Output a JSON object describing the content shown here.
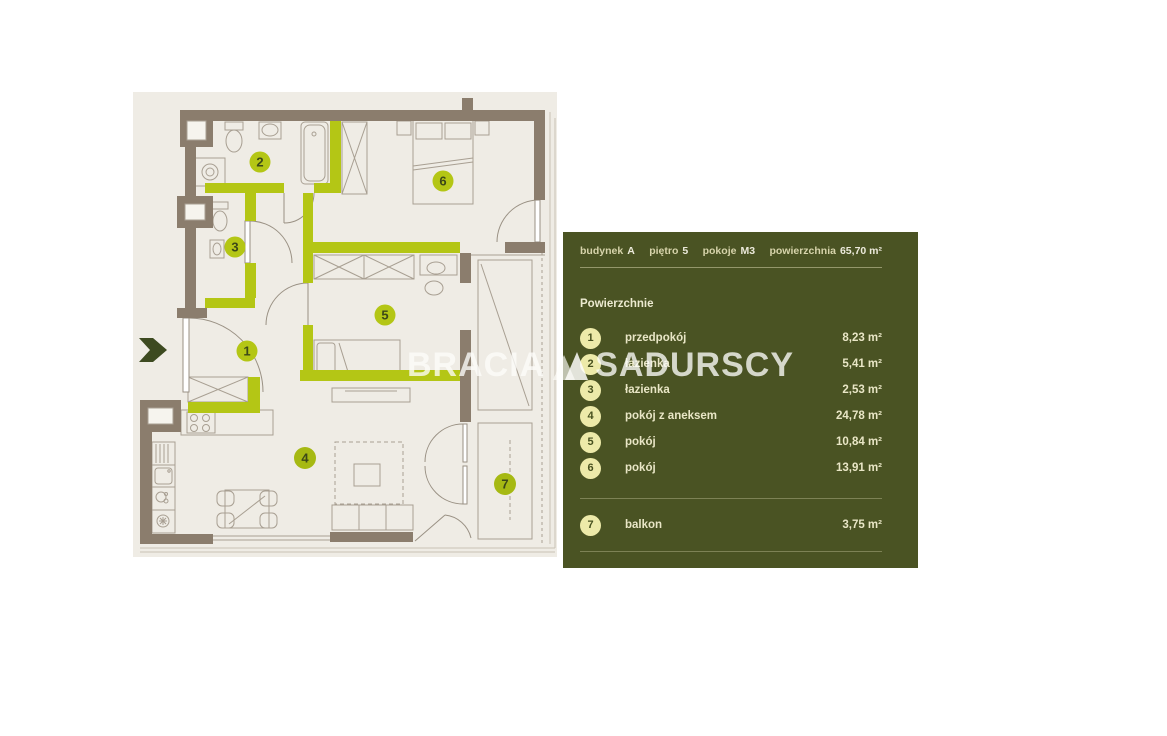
{
  "watermark": {
    "left": "BRACIA",
    "right": "SADURSCY",
    "logo_icon": "triangles-logo"
  },
  "panel": {
    "bg_color": "#4a5323",
    "text_color": "#e7e4c2",
    "chip_color": "#edeaa9",
    "header": [
      {
        "label": "budynek",
        "value": "A"
      },
      {
        "label": "piętro",
        "value": "5"
      },
      {
        "label": "pokoje",
        "value": "M3"
      },
      {
        "label": "powierzchnia",
        "value": "65,70 m²"
      }
    ],
    "section_title": "Powierzchnie",
    "rooms": [
      {
        "num": "1",
        "name": "przedpokój",
        "area": "8,23 m²"
      },
      {
        "num": "2",
        "name": "łazienka",
        "area": "5,41 m²"
      },
      {
        "num": "3",
        "name": "łazienka",
        "area": "2,53 m²"
      },
      {
        "num": "4",
        "name": "pokój z aneksem",
        "area": "24,78 m²"
      },
      {
        "num": "5",
        "name": "pokój",
        "area": "10,84 m²"
      },
      {
        "num": "6",
        "name": "pokój",
        "area": "13,91 m²"
      }
    ],
    "extra_rooms": [
      {
        "num": "7",
        "name": "balkon",
        "area": "3,75 m²"
      }
    ]
  },
  "floorplan": {
    "colors": {
      "background": "#efece5",
      "wall_brown": "#8b7d6d",
      "wall_lime": "#b4c615",
      "circle_lime": "#b4c615",
      "circle_dark_lime": "#a6b913",
      "number_color": "#3c4818",
      "furniture_line": "#a89f92",
      "entrance_arrow": "#3d4a20"
    },
    "room_labels": [
      "1",
      "2",
      "3",
      "4",
      "5",
      "6",
      "7"
    ],
    "entrance_icon": "entrance-arrow-icon"
  }
}
